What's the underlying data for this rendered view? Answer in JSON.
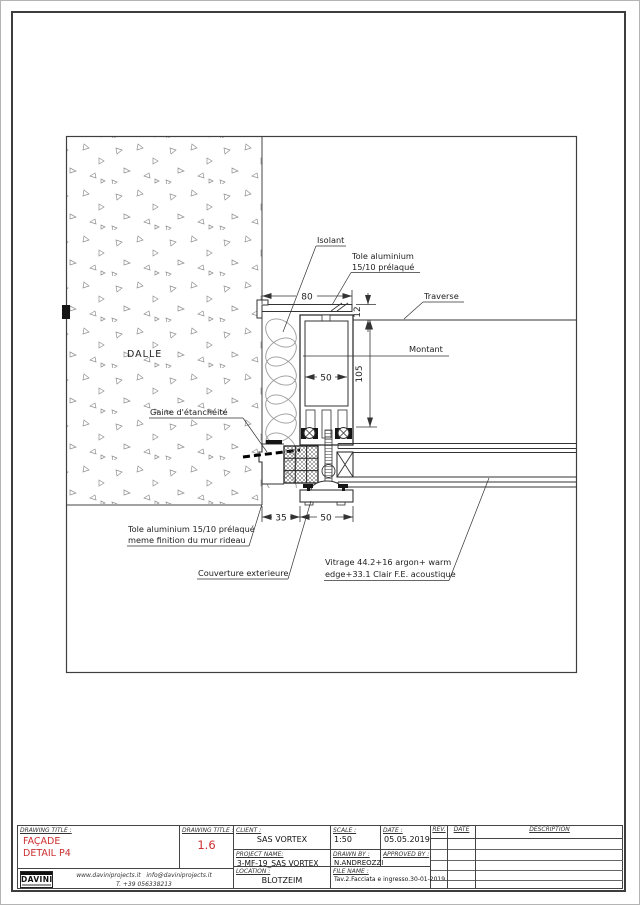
{
  "drawing": {
    "wall_label": "DALLE",
    "callouts": {
      "isolant": "Isolant",
      "tole_top_1": "Tole aluminium",
      "tole_top_2": "15/10 prélaqué",
      "traverse": "Traverse",
      "montant": "Montant",
      "gaine": "Gaine d'étanchéité",
      "tole_bottom_1": "Tole aluminium 15/10 prélaqué",
      "tole_bottom_2": "meme finition du mur rideau",
      "couverture": "Couverture exterieure",
      "vitrage_1": "Vitrage 44.2+16 argon+ warm",
      "vitrage_2": "edge+33.1 Clair F.E. acoustique"
    },
    "dims": {
      "top_width": "80",
      "plate_thickness": "12",
      "mullion_inner_width": "50",
      "mullion_depth": "105",
      "offset": "35",
      "bottom_width": "50"
    }
  },
  "title_block": {
    "accent_color": "#cc2f2f",
    "drawing_title_label": "DRAWING TITLE :",
    "drawing_title_1": "FAÇADE",
    "drawing_title_2": "DETAIL P4",
    "drawing_number": "1.6",
    "client_label": "CLIENT :",
    "client": "SAS VORTEX",
    "scale_label": "SCALE :",
    "scale": "1:50",
    "date_label": "DATE :",
    "date": "05.05.2019",
    "project_name_label": "PROJECT NAME:",
    "project_name": "3-MF-19_SAS VORTEX",
    "drawn_by_label": "DRAWN BY :",
    "drawn_by": "N.ANDREOZZI",
    "approved_by_label": "APPROVED BY :",
    "approved_by": "",
    "location_label": "LOCATION :",
    "location": "BLOTZEIM",
    "file_name_label": "FILE NAME :",
    "file_name": "Tav.2.Facciata e ingresso.30-01-2019",
    "rev_label": "REV.",
    "rev_date_label": "DATE",
    "description_label": "DESCRIPTION",
    "logo_text": "DAVINI",
    "contact_web": "www.daviniprojects.it",
    "contact_email": "info@daviniprojects.it",
    "contact_phone": "T. +39 056338213"
  }
}
